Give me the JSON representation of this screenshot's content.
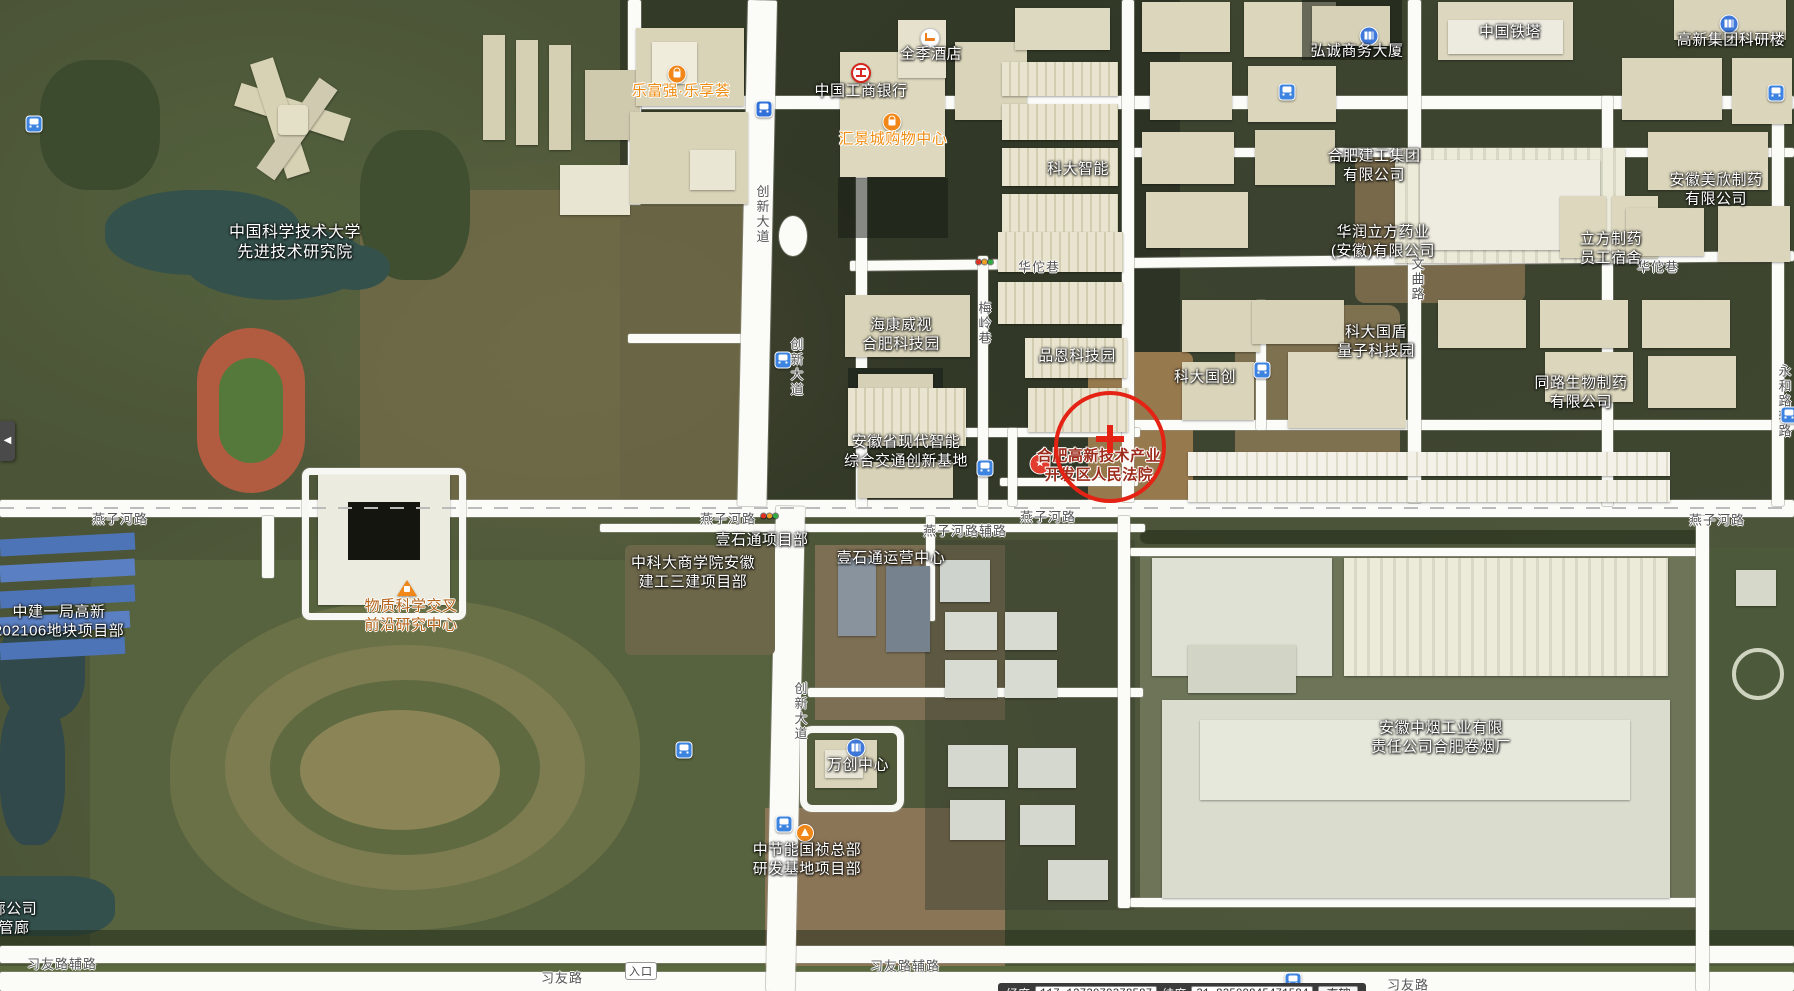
{
  "map": {
    "colors": {
      "annotation_red": "#e42315",
      "poi_orange": "#ef8d12",
      "poi_government_red": "#9c2b1b",
      "poi_brown": "#b4631a",
      "transit_blue": "#3d83e0",
      "road_white": "#fbfbf8"
    },
    "annotation": {
      "circle": {
        "x": 1110,
        "y": 447,
        "r": 54
      },
      "cross": {
        "x": 1110,
        "y": 439,
        "arm": 14,
        "thickness": 6
      }
    },
    "place_labels": [
      {
        "lines": [
          "中国科学技术大学",
          "先进技术研究院"
        ],
        "x": 295,
        "y": 243,
        "cls": "white",
        "size": 16
      },
      {
        "lines": [
          "全季酒店"
        ],
        "x": 931,
        "y": 55,
        "cls": "white"
      },
      {
        "lines": [
          "中国工商银行"
        ],
        "x": 861,
        "y": 92,
        "cls": "white"
      },
      {
        "lines": [
          "汇景城购物中心"
        ],
        "x": 893,
        "y": 140,
        "cls": "orange"
      },
      {
        "lines": [
          "乐富强·乐享荟"
        ],
        "x": 681,
        "y": 92,
        "cls": "orange"
      },
      {
        "lines": [
          "科大智能"
        ],
        "x": 1078,
        "y": 170,
        "cls": "white"
      },
      {
        "lines": [
          "弘诚商务大厦"
        ],
        "x": 1357,
        "y": 52,
        "cls": "white"
      },
      {
        "lines": [
          "中国铁塔"
        ],
        "x": 1510,
        "y": 33,
        "cls": "white"
      },
      {
        "lines": [
          "高新集团科研楼"
        ],
        "x": 1731,
        "y": 41,
        "cls": "white"
      },
      {
        "lines": [
          "合肥建工集团",
          "有限公司"
        ],
        "x": 1374,
        "y": 166,
        "cls": "white"
      },
      {
        "lines": [
          "安徽美欣制药",
          "有限公司"
        ],
        "x": 1716,
        "y": 190,
        "cls": "white"
      },
      {
        "lines": [
          "华润立方药业",
          "(安徽)有限公司"
        ],
        "x": 1383,
        "y": 242,
        "cls": "white"
      },
      {
        "lines": [
          "立方制药",
          "员工宿舍"
        ],
        "x": 1611,
        "y": 249,
        "cls": "white"
      },
      {
        "lines": [
          "海康威视",
          "合肥科技园"
        ],
        "x": 901,
        "y": 335,
        "cls": "white"
      },
      {
        "lines": [
          "品恩科技园"
        ],
        "x": 1077,
        "y": 357,
        "cls": "white"
      },
      {
        "lines": [
          "科大国创"
        ],
        "x": 1205,
        "y": 378,
        "cls": "white"
      },
      {
        "lines": [
          "科大国盾",
          "量子科技园"
        ],
        "x": 1376,
        "y": 342,
        "cls": "white"
      },
      {
        "lines": [
          "同路生物制药",
          "有限公司"
        ],
        "x": 1581,
        "y": 393,
        "cls": "white"
      },
      {
        "lines": [
          "安徽省现代智能",
          "综合交通创新基地"
        ],
        "x": 906,
        "y": 452,
        "cls": "white"
      },
      {
        "lines": [
          "合肥高新技术产业",
          "开发区人民法院"
        ],
        "x": 1099,
        "y": 466,
        "cls": "red"
      },
      {
        "lines": [
          "中建一局高新",
          "202106地块项目部"
        ],
        "x": 59,
        "y": 622,
        "cls": "white"
      },
      {
        "lines": [
          "物质科学交叉",
          "前沿研究中心"
        ],
        "x": 411,
        "y": 616,
        "cls": "brown"
      },
      {
        "lines": [
          "壹石通项目部"
        ],
        "x": 762,
        "y": 541,
        "cls": "white"
      },
      {
        "lines": [
          "中科大商学院安徽",
          "建工三建项目部"
        ],
        "x": 693,
        "y": 573,
        "cls": "white"
      },
      {
        "lines": [
          "壹石通运营中心"
        ],
        "x": 891,
        "y": 559,
        "cls": "white"
      },
      {
        "lines": [
          "万创中心"
        ],
        "x": 858,
        "y": 766,
        "cls": "white"
      },
      {
        "lines": [
          "中节能国祯总部",
          "研发基地项目部"
        ],
        "x": 807,
        "y": 860,
        "cls": "white"
      },
      {
        "lines": [
          "安徽中烟工业有限",
          "责任公司合肥卷烟厂"
        ],
        "x": 1441,
        "y": 738,
        "cls": "white"
      },
      {
        "lines": [
          "廊公司",
          "管廊"
        ],
        "x": 14,
        "y": 919,
        "cls": "white"
      }
    ],
    "road_labels": [
      {
        "text": "创新大道",
        "x": 763,
        "y": 215,
        "vertical": true
      },
      {
        "text": "创新大道",
        "x": 797,
        "y": 368,
        "vertical": true
      },
      {
        "text": "创新大道",
        "x": 801,
        "y": 712,
        "vertical": true
      },
      {
        "text": "华佗巷",
        "x": 1039,
        "y": 266
      },
      {
        "text": "华佗巷",
        "x": 1658,
        "y": 266
      },
      {
        "text": "梅岭巷",
        "x": 985,
        "y": 324,
        "vertical": true
      },
      {
        "text": "文曲路",
        "x": 1418,
        "y": 280,
        "vertical": true
      },
      {
        "text": "永和路辅路",
        "x": 1785,
        "y": 402,
        "vertical": true
      },
      {
        "text": "燕子河路",
        "x": 120,
        "y": 518
      },
      {
        "text": "燕子河路",
        "x": 728,
        "y": 518
      },
      {
        "text": "燕子河路",
        "x": 1048,
        "y": 516
      },
      {
        "text": "燕子河路",
        "x": 1717,
        "y": 519
      },
      {
        "text": "燕子河路辅路",
        "x": 965,
        "y": 530
      },
      {
        "text": "习友路辅路",
        "x": 62,
        "y": 963
      },
      {
        "text": "习友路",
        "x": 562,
        "y": 977
      },
      {
        "text": "习友路辅路",
        "x": 905,
        "y": 965
      },
      {
        "text": "习友路",
        "x": 1408,
        "y": 984
      },
      {
        "text": "入口",
        "x": 641,
        "y": 971,
        "box": true
      }
    ],
    "icons": [
      {
        "type": "bus",
        "x": 34,
        "y": 124
      },
      {
        "type": "metro",
        "x": 764,
        "y": 109
      },
      {
        "type": "bus",
        "x": 1287,
        "y": 92
      },
      {
        "type": "bus",
        "x": 1776,
        "y": 93
      },
      {
        "type": "bus",
        "x": 783,
        "y": 360
      },
      {
        "type": "bus",
        "x": 985,
        "y": 468
      },
      {
        "type": "bus",
        "x": 1262,
        "y": 370
      },
      {
        "type": "bus",
        "x": 1789,
        "y": 415
      },
      {
        "type": "bus",
        "x": 684,
        "y": 750
      },
      {
        "type": "bus",
        "x": 784,
        "y": 824
      },
      {
        "type": "bus",
        "x": 1293,
        "y": 981
      },
      {
        "type": "bag",
        "x": 677,
        "y": 74
      },
      {
        "type": "bag",
        "x": 892,
        "y": 122
      },
      {
        "type": "icbc",
        "x": 861,
        "y": 73
      },
      {
        "type": "hotel",
        "x": 930,
        "y": 38
      },
      {
        "type": "bldg",
        "x": 1369,
        "y": 36
      },
      {
        "type": "bldg",
        "x": 1729,
        "y": 24
      },
      {
        "type": "bldg",
        "x": 856,
        "y": 748
      },
      {
        "type": "star",
        "x": 1040,
        "y": 464
      },
      {
        "type": "warn",
        "x": 407,
        "y": 588
      },
      {
        "type": "flask",
        "x": 805,
        "y": 833
      },
      {
        "type": "traffic",
        "x": 986,
        "y": 262
      },
      {
        "type": "traffic",
        "x": 771,
        "y": 516
      }
    ],
    "icon_names": {
      "bus": "bus-stop-icon",
      "metro": "metro-station-icon",
      "bag": "shopping-icon",
      "icbc": "bank-icon",
      "hotel": "hotel-icon",
      "bldg": "building-icon",
      "star": "government-poi-icon",
      "warn": "construction-icon",
      "flask": "lab-icon",
      "traffic": "traffic-light-icon"
    }
  },
  "panel_toggle": {
    "glyph": "◀"
  },
  "coordbar": {
    "lng_label": "经度",
    "lng_value": "117.1273079378587",
    "lat_label": "纬度",
    "lat_value": "31.82509845471584",
    "region_button": "直辖"
  }
}
